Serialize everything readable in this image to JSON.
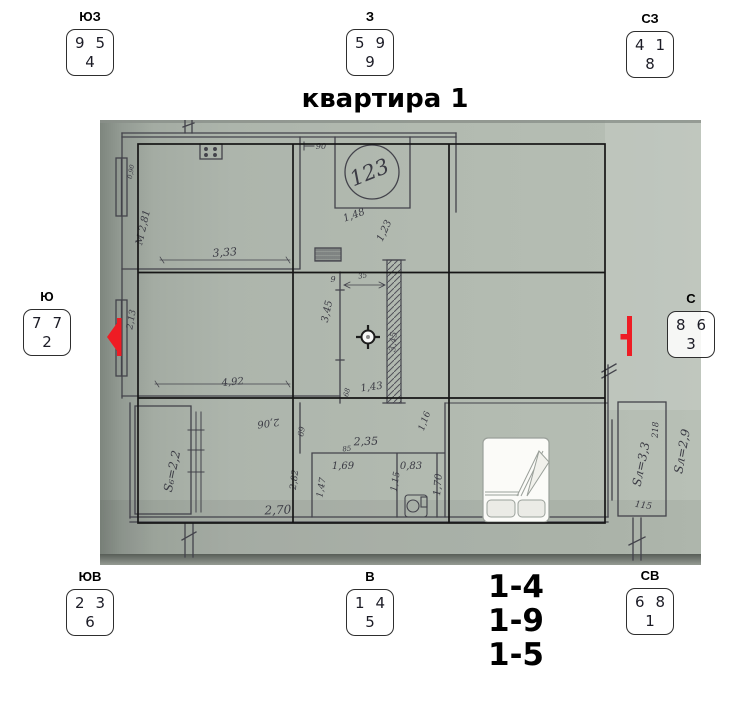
{
  "title": "квартира 1",
  "compass": {
    "sw": {
      "label": "ЮЗ",
      "top_left": "9",
      "top_right": "5",
      "bottom": "4"
    },
    "w": {
      "label": "З",
      "top_left": "5",
      "top_right": "9",
      "bottom": "9"
    },
    "nw": {
      "label": "СЗ",
      "top_left": "4",
      "top_right": "1",
      "bottom": "8"
    },
    "s": {
      "label": "Ю",
      "top_left": "7",
      "top_right": "7",
      "bottom": "2"
    },
    "n": {
      "label": "С",
      "top_left": "8",
      "top_right": "6",
      "bottom": "3"
    },
    "se": {
      "label": "ЮВ",
      "top_left": "2",
      "top_right": "3",
      "bottom": "6"
    },
    "e": {
      "label": "В",
      "top_left": "1",
      "top_right": "4",
      "bottom": "5"
    },
    "ne": {
      "label": "СВ",
      "top_left": "6",
      "top_right": "8",
      "bottom": "1"
    }
  },
  "star_pairs": {
    "line1": "1-4",
    "line2": "1-9",
    "line3": "1-5"
  },
  "plan": {
    "room_circle_number": "123",
    "m": {
      "v090": "0,90",
      "v281": "М 2,81",
      "v333": "3,33",
      "v90": "90",
      "v148": "1,48",
      "v123": "1,23",
      "v9": "9",
      "v35": "35",
      "v345a": "3,45",
      "v345b": "3,45",
      "v143": "1,43",
      "v68": "68",
      "v213": "2,13",
      "v492": "4,92",
      "v206": "2,06",
      "v69": "69",
      "v282": "2,82",
      "s_room": "S₆=2,2",
      "v270": "2,70",
      "v235": "2,35",
      "v85": "85",
      "v169": "1,69",
      "v083": "0,83",
      "v147": "1,47",
      "v115a": "1,15",
      "v170": "1,70",
      "v116": "1,16",
      "v218": "218",
      "s_balcony1": "Sл=3,3",
      "v115b": "115",
      "s_balcony2": "Sл=2,9"
    },
    "colors": {
      "photo_background": "#b0b8ae",
      "grid_line": "#161616",
      "marker_red": "#ee1c24",
      "ink": "#3b3b44"
    }
  }
}
